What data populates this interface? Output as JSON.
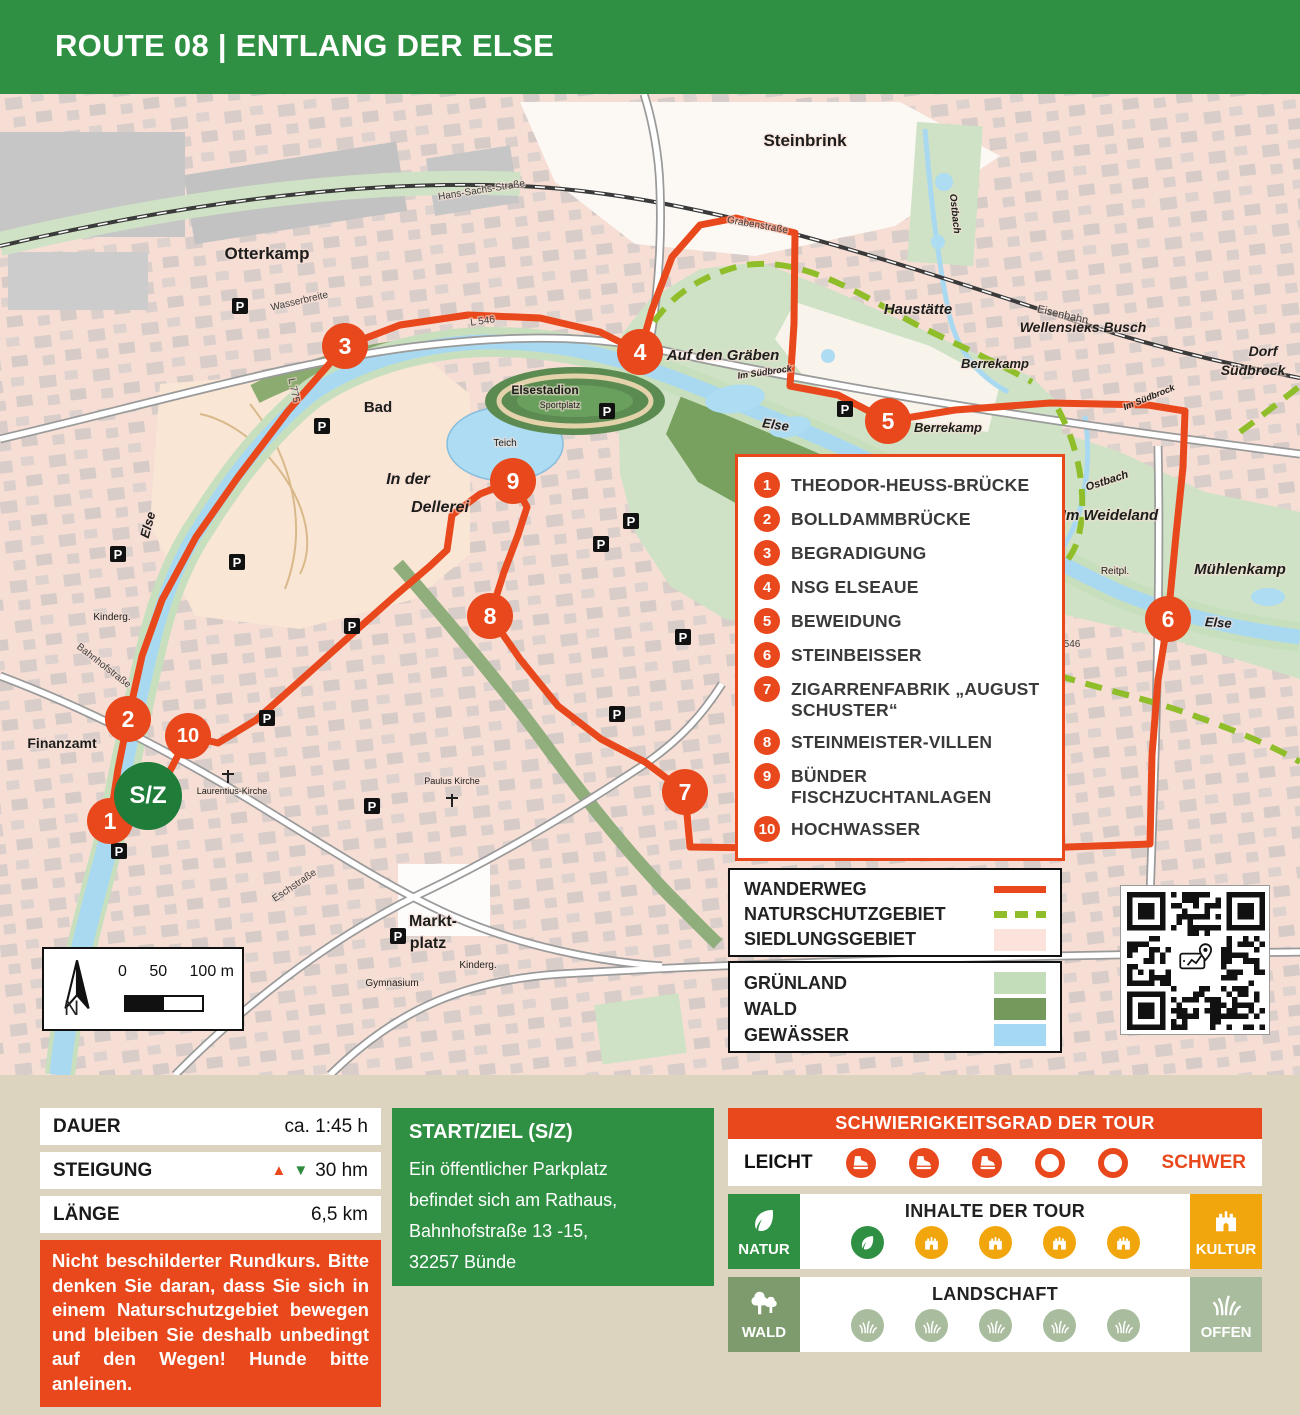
{
  "header": {
    "title": "ROUTE 08 | ENTLANG DER ELSE"
  },
  "colors": {
    "accent": "#e8481c",
    "green": "#2f9043",
    "start_marker_green": "#1f7c39",
    "kultur": "#f2a60d",
    "wald_square": "#7d9b6d",
    "sage": "#a9bc9e",
    "nsg_dash": "#8fbe2a",
    "siedlung": "#fbe3dc",
    "gruenland": "#c3dcb9",
    "wald_area": "#74995c",
    "gewaesser": "#a5d8f2"
  },
  "map": {
    "start_marker": {
      "label": "S/Z",
      "x": 148,
      "y": 702
    },
    "parking_label": "P",
    "parking": [
      [
        240,
        212
      ],
      [
        322,
        332
      ],
      [
        118,
        460
      ],
      [
        237,
        468
      ],
      [
        607,
        317
      ],
      [
        631,
        427
      ],
      [
        601,
        450
      ],
      [
        683,
        543
      ],
      [
        352,
        532
      ],
      [
        267,
        624
      ],
      [
        119,
        757
      ],
      [
        372,
        712
      ],
      [
        398,
        842
      ],
      [
        617,
        620
      ],
      [
        845,
        315
      ]
    ],
    "waypoints": [
      {
        "n": "1",
        "x": 110,
        "y": 727
      },
      {
        "n": "2",
        "x": 128,
        "y": 625
      },
      {
        "n": "3",
        "x": 345,
        "y": 252
      },
      {
        "n": "4",
        "x": 640,
        "y": 258
      },
      {
        "n": "5",
        "x": 888,
        "y": 327
      },
      {
        "n": "6",
        "x": 1168,
        "y": 525
      },
      {
        "n": "7",
        "x": 685,
        "y": 698
      },
      {
        "n": "8",
        "x": 490,
        "y": 522
      },
      {
        "n": "9",
        "x": 513,
        "y": 387
      },
      {
        "n": "10",
        "x": 188,
        "y": 642
      }
    ],
    "poi": {
      "items": [
        {
          "num": "1",
          "label": "THEODOR-HEUSS-BRÜCKE"
        },
        {
          "num": "2",
          "label": "BOLLDAMMBRÜCKE"
        },
        {
          "num": "3",
          "label": "BEGRADIGUNG"
        },
        {
          "num": "4",
          "label": "NSG ELSEAUE"
        },
        {
          "num": "5",
          "label": "BEWEIDUNG"
        },
        {
          "num": "6",
          "label": "STEINBEISSER"
        },
        {
          "num": "7",
          "label": "ZIGARRENFABRIK „AUGUST SCHUSTER“"
        },
        {
          "num": "8",
          "label": "STEINMEISTER-VILLEN"
        },
        {
          "num": "9",
          "label": "BÜNDER FISCHZUCHTANLAGEN"
        },
        {
          "num": "10",
          "label": "HOCHWASSER"
        }
      ]
    },
    "legend_routes": {
      "items": [
        {
          "label": "WANDERWEG",
          "sym": "line"
        },
        {
          "label": "NATURSCHUTZGEBIET",
          "sym": "dash"
        },
        {
          "label": "SIEDLUNGSGEBIET",
          "sym": "swatch",
          "color": "#fbe3dc"
        }
      ]
    },
    "legend_areas": {
      "items": [
        {
          "label": "GRÜNLAND",
          "sym": "swatch",
          "color": "#c3dcb9"
        },
        {
          "label": "WALD",
          "sym": "swatch",
          "color": "#74995c"
        },
        {
          "label": "GEWÄSSER",
          "sym": "swatch",
          "color": "#a5d8f2"
        }
      ]
    },
    "scale": {
      "north": "N",
      "ticks": [
        "0",
        "50",
        "100 m"
      ]
    },
    "labels": [
      {
        "t": "Steinbrink",
        "x": 805,
        "y": 52,
        "s": 17,
        "c": "b"
      },
      {
        "t": "Otterkamp",
        "x": 267,
        "y": 165,
        "s": 17,
        "c": "b"
      },
      {
        "t": "Haustätte",
        "x": 918,
        "y": 220,
        "s": 15,
        "c": "i"
      },
      {
        "t": "Wellensieks Busch",
        "x": 1083,
        "y": 238,
        "s": 14,
        "c": "i"
      },
      {
        "t": "Auf den Gräben",
        "x": 723,
        "y": 266,
        "s": 15,
        "c": "i"
      },
      {
        "t": "Berrekamp",
        "x": 995,
        "y": 274,
        "s": 13,
        "c": "i"
      },
      {
        "t": "Berrekamp",
        "x": 948,
        "y": 338,
        "s": 13,
        "c": "i"
      },
      {
        "t": "Dorf",
        "x": 1263,
        "y": 262,
        "s": 14,
        "c": "i"
      },
      {
        "t": "Südbrock",
        "x": 1253,
        "y": 281,
        "s": 14,
        "c": "i"
      },
      {
        "t": "Im Weideland",
        "x": 1110,
        "y": 426,
        "s": 15,
        "c": "i"
      },
      {
        "t": "Mühlenkamp",
        "x": 1240,
        "y": 480,
        "s": 15,
        "c": "i"
      },
      {
        "t": "Ostbach",
        "x": 1108,
        "y": 390,
        "s": 11,
        "c": "i",
        "r": -18
      },
      {
        "t": "Ostbach",
        "x": 952,
        "y": 120,
        "s": 10,
        "c": "i",
        "r": 84
      },
      {
        "t": "Else",
        "x": 775,
        "y": 335,
        "s": 13,
        "c": "i",
        "r": 8
      },
      {
        "t": "Else",
        "x": 1218,
        "y": 533,
        "s": 13,
        "c": "i",
        "r": 4
      },
      {
        "t": "Else",
        "x": 152,
        "y": 432,
        "s": 13,
        "c": "i",
        "r": -75
      },
      {
        "t": "Eisenbahn",
        "x": 1062,
        "y": 224,
        "s": 11,
        "c": "st",
        "r": 13
      },
      {
        "t": "Im Südbrock",
        "x": 1150,
        "y": 306,
        "s": 9,
        "c": "i",
        "r": -22
      },
      {
        "t": "Im Südbrock",
        "x": 765,
        "y": 281,
        "s": 9,
        "c": "i",
        "r": -8
      },
      {
        "t": "Reitpl.",
        "x": 1115,
        "y": 480,
        "s": 10,
        "c": "s"
      },
      {
        "t": "Elsestadion",
        "x": 545,
        "y": 300,
        "s": 12,
        "c": "b"
      },
      {
        "t": "Sportplatz",
        "x": 560,
        "y": 314,
        "s": 9,
        "c": "s"
      },
      {
        "t": "Bad",
        "x": 378,
        "y": 318,
        "s": 15,
        "c": "b"
      },
      {
        "t": "In der",
        "x": 408,
        "y": 390,
        "s": 16,
        "c": "i"
      },
      {
        "t": "Dellerei",
        "x": 440,
        "y": 418,
        "s": 16,
        "c": "i"
      },
      {
        "t": "Teich",
        "x": 505,
        "y": 352,
        "s": 10,
        "c": "s"
      },
      {
        "t": "Markt-",
        "x": 433,
        "y": 832,
        "s": 16,
        "c": "b"
      },
      {
        "t": "platz",
        "x": 428,
        "y": 854,
        "s": 16,
        "c": "b"
      },
      {
        "t": "Finanzamt",
        "x": 62,
        "y": 654,
        "s": 14,
        "c": "b"
      },
      {
        "t": "Gymnasium",
        "x": 392,
        "y": 892,
        "s": 10,
        "c": "s"
      },
      {
        "t": "Laurentius-Kirche",
        "x": 232,
        "y": 700,
        "s": 9,
        "c": "s"
      },
      {
        "t": "Paulus Kirche",
        "x": 452,
        "y": 690,
        "s": 9,
        "c": "s"
      },
      {
        "t": "Kinderg.",
        "x": 112,
        "y": 526,
        "s": 10,
        "c": "s"
      },
      {
        "t": "Kinderg.",
        "x": 478,
        "y": 874,
        "s": 10,
        "c": "s"
      },
      {
        "t": "Grabenstraße",
        "x": 757,
        "y": 134,
        "s": 10,
        "c": "st",
        "r": 10
      },
      {
        "t": "Hans-Sachs-Straße",
        "x": 482,
        "y": 99,
        "s": 10,
        "c": "st",
        "r": -9
      },
      {
        "t": "Wasserbreite",
        "x": 300,
        "y": 210,
        "s": 10,
        "c": "st",
        "r": -13
      },
      {
        "t": "Bahnhofstraße",
        "x": 102,
        "y": 574,
        "s": 10,
        "c": "st",
        "r": 38
      },
      {
        "t": "Eschstraße",
        "x": 296,
        "y": 794,
        "s": 10,
        "c": "st",
        "r": -34
      },
      {
        "t": "L 546",
        "x": 483,
        "y": 230,
        "s": 10,
        "c": "st",
        "r": -8
      },
      {
        "t": "L 546",
        "x": 1068,
        "y": 553,
        "s": 10,
        "c": "st"
      },
      {
        "t": "L 775",
        "x": 291,
        "y": 297,
        "s": 10,
        "c": "st",
        "r": 78
      }
    ]
  },
  "info": {
    "arrow_up": "▲",
    "arrow_down": "▼",
    "stats": [
      {
        "label": "DAUER",
        "value": "ca. 1:45 h",
        "arrows": false
      },
      {
        "label": "STEIGUNG",
        "value": "30 hm",
        "arrows": true
      },
      {
        "label": "LÄNGE",
        "value": "6,5 km",
        "arrows": false
      }
    ],
    "warning": "Nicht beschilderter Rundkurs. Bitte denken Sie daran, dass Sie sich in einem Naturschutzgebiet bewegen und bleiben Sie deshalb unbedingt auf den Wegen! Hunde bitte anleinen.",
    "start": {
      "title": "START/ZIEL (S/Z)",
      "lines": [
        "Ein öffentlicher Parkplatz",
        "befindet sich am Rathaus,",
        "Bahnhofstraße 13 -15,",
        "32257 Bünde"
      ]
    },
    "difficulty": {
      "title": "SCHWIERIGKEITSGRAD DER TOUR",
      "left": "LEICHT",
      "right": "SCHWER",
      "filled": 3,
      "total": 5
    },
    "content": {
      "title": "INHALTE DER TOUR",
      "left_label": "NATUR",
      "right_label": "KULTUR",
      "nature_count": 1,
      "culture_count": 4
    },
    "landscape": {
      "title": "LANDSCHAFT",
      "left_label": "WALD",
      "right_label": "OFFEN",
      "count": 5
    }
  }
}
